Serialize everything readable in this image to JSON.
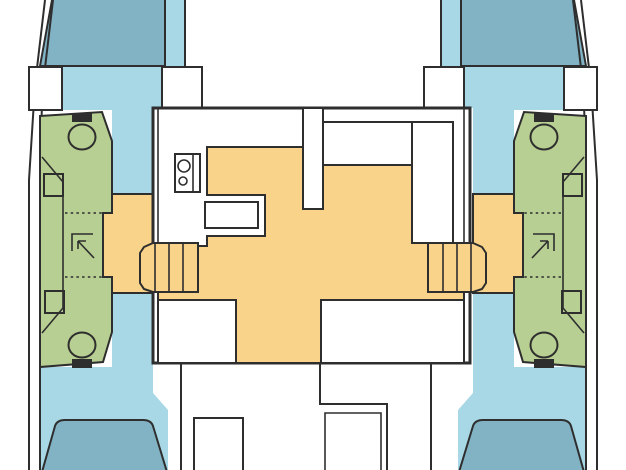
{
  "diagram": {
    "type": "catamaran-deck-plan",
    "description": "Top-down interior layout plan of a 4-cabin catamaran, no text labels",
    "hulls": [
      "port",
      "starboard"
    ],
    "rooms": [
      {
        "name": "forward-berth-port",
        "color_key": "berth"
      },
      {
        "name": "forward-berth-starboard",
        "color_key": "berth"
      },
      {
        "name": "aft-berth-port",
        "color_key": "berth"
      },
      {
        "name": "aft-berth-starboard",
        "color_key": "berth"
      },
      {
        "name": "bathroom-port",
        "color_key": "bathroom",
        "fixtures": [
          "toilet-forward",
          "sink-forward",
          "shower-stall",
          "sink-aft",
          "toilet-aft"
        ]
      },
      {
        "name": "bathroom-starboard",
        "color_key": "bathroom",
        "fixtures": [
          "toilet-forward",
          "sink-forward",
          "shower-stall",
          "sink-aft",
          "toilet-aft"
        ]
      },
      {
        "name": "salon",
        "color_key": "floor",
        "fixtures": [
          "galley-stove",
          "galley-sink",
          "l-settee",
          "companionway-stairs-port",
          "companionway-stairs-starboard"
        ]
      },
      {
        "name": "cockpit",
        "color_key": "background",
        "fixtures": [
          "cockpit-table",
          "cockpit-bench"
        ]
      }
    ]
  },
  "colors": {
    "hull_interior": "#a8d8e5",
    "berth": "#82b3c4",
    "bathroom": "#b7cf92",
    "floor": "#f9d38a",
    "outline": "#2e2e2e",
    "background": "#ffffff"
  }
}
